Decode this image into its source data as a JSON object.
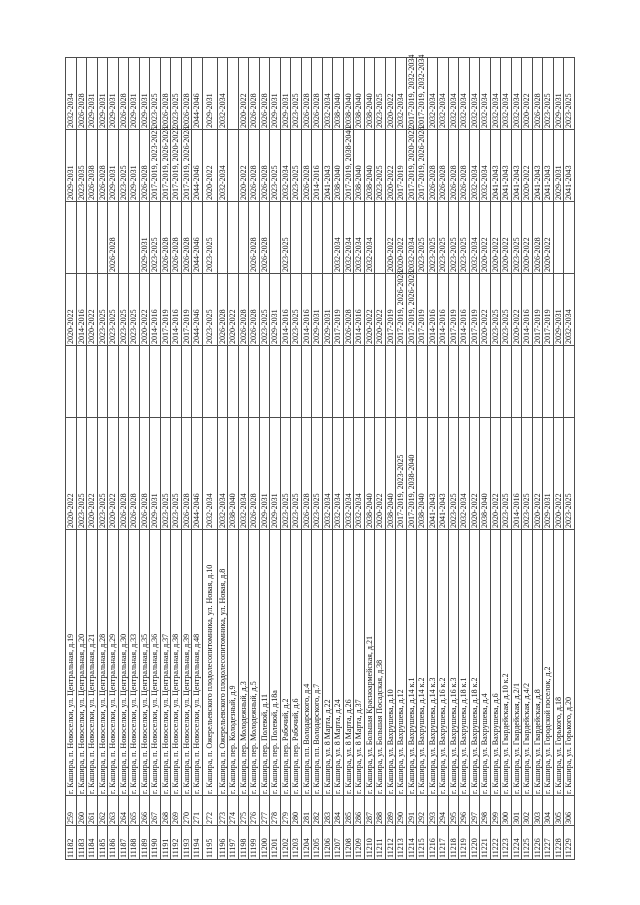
{
  "page": {
    "background": "#ffffff",
    "text_color": "#141414",
    "grid_color": "#4d4d4d"
  },
  "table": {
    "description_of_visible_content": "portion of a rotated schedule table: row number, ordinal number, building address, and planned year-range periods",
    "tall_row_index": 13,
    "rows": [
      [
        "11182",
        "259",
        "г. Кашира, п. Новоселки, ул. Центральная, д.19",
        "2020-2022",
        "",
        "2020-2022",
        "",
        "2029-2031",
        "2032-2034"
      ],
      [
        "11183",
        "260",
        "г. Кашира, п. Новоселки, ул. Центральная, д.20",
        "2023-2025",
        "",
        "2014-2016",
        "",
        "2023-2035",
        "2026-2028"
      ],
      [
        "11184",
        "261",
        "г. Кашира, п. Новоселки, ул. Центральная, д.21",
        "2020-2022",
        "",
        "2020-2022",
        "",
        "2026-2038",
        "2029-2031"
      ],
      [
        "11185",
        "262",
        "г. Кашира, п. Новоселки, ул. Центральная, д.28",
        "2023-2025",
        "",
        "2023-2025",
        "",
        "2026-2028",
        "2029-2031"
      ],
      [
        "11186",
        "263",
        "г. Кашира, п. Новоселки, ул. Центральная, д.29",
        "2020-2022",
        "",
        "2023-2025",
        "2026-2028",
        "2029-2031",
        "2029-2031"
      ],
      [
        "11187",
        "264",
        "г. Кашира, п. Новоселки, ул. Центральная, д.30",
        "2026-2028",
        "",
        "2023-2025",
        "",
        "2023-2025",
        "2026-2028"
      ],
      [
        "11188",
        "265",
        "г. Кашира, п. Новоселки, ул. Центральная, д.33",
        "2026-2028",
        "",
        "2023-2025",
        "",
        "2029-2031",
        "2029-2031"
      ],
      [
        "11189",
        "266",
        "г. Кашира, п. Новоселки, ул. Центральная, д.35",
        "2026-2028",
        "",
        "2020-2022",
        "2029-2031",
        "2026-2028",
        "2029-2031"
      ],
      [
        "11190",
        "267",
        "г. Кашира, п. Новоселки, ул. Центральная, д.36",
        "2029-2031",
        "",
        "2014-2016",
        "2023-2025",
        "2017-2019, 2023-2025",
        "2023-2025"
      ],
      [
        "11191",
        "268",
        "г. Кашира, п. Новоселки, ул. Центральная, д.37",
        "2023-2025",
        "",
        "2017-2019",
        "2026-2028",
        "2017-2019, 2026-2028",
        "2026-2028"
      ],
      [
        "11192",
        "269",
        "г. Кашира, п. Новоселки, ул. Центральная, д.38",
        "2023-2025",
        "",
        "2014-2016",
        "2026-2028",
        "2017-2019, 2020-2022",
        "2023-2025"
      ],
      [
        "11193",
        "270",
        "г. Кашира, п. Новоселки, ул. Центральная, д.39",
        "2026-2028",
        "",
        "2017-2019",
        "2026-2028",
        "2017-2019, 2026-2028",
        "2026-2028"
      ],
      [
        "11194",
        "271",
        "г. Кашира, п. Новоселки, ул. Центральная, д.48",
        "2044-2046",
        "",
        "2044-2046",
        "2044-2046",
        "2044-2046",
        "2044-2046"
      ],
      [
        "11195",
        "272",
        "г. Кашира, п. Ожерельевского плодолесопитомника, ул. Новая, д.10",
        "2032-2034",
        "",
        "2023-2025",
        "2023-2025",
        "2020-2022",
        "2029-2031"
      ],
      [
        "11196",
        "273",
        "г. Кашира, п. Ожерельевского плодолесопитомника, ул. Новая, д.8",
        "2032-2034",
        "",
        "2026-2028",
        "",
        "2032-2034",
        "2032-2034"
      ],
      [
        "11197",
        "274",
        "г. Кашира, пер. Колодезный, д.9",
        "2038-2040",
        "",
        "2020-2022",
        "",
        "",
        ""
      ],
      [
        "11198",
        "275",
        "г. Кашира, пер. Молодежный, д.3",
        "2032-2034",
        "",
        "2026-2028",
        "",
        "2020-2022",
        "2020-2022"
      ],
      [
        "11199",
        "276",
        "г. Кашира, пер. Молодежный, д.5",
        "2026-2028",
        "",
        "2026-2028",
        "2026-2028",
        "2026-2028",
        "2026-2028"
      ],
      [
        "11200",
        "277",
        "г. Кашира, пер. Полевой, д.11",
        "2029-2031",
        "",
        "2023-2025",
        "2026-2028",
        "2026-2028",
        "2026-2028"
      ],
      [
        "11201",
        "278",
        "г. Кашира, пер. Полевой, д.18а",
        "2029-2031",
        "",
        "2029-2031",
        "",
        "2023-2025",
        "2029-2031"
      ],
      [
        "11202",
        "279",
        "г. Кашира, пер. Рабочий, д.2",
        "2023-2025",
        "",
        "2014-2016",
        "2023-2025",
        "2032-2034",
        "2029-2031"
      ],
      [
        "11203",
        "280",
        "г. Кашира, пер. Рабочий, д.6",
        "2023-2025",
        "",
        "2023-2025",
        "",
        "2023-2025",
        "2023-2025"
      ],
      [
        "11204",
        "281",
        "г. Кашира, пл. Володарского, д.4",
        "2026-2028",
        "",
        "2014-2016",
        "",
        "2026-2028",
        "2026-2028"
      ],
      [
        "11205",
        "282",
        "г. Кашира, пл. Володарского, д.7",
        "2023-2025",
        "",
        "2029-2031",
        "",
        "2014-2016",
        "2026-2028"
      ],
      [
        "11206",
        "283",
        "г. Кашира, ул. 8 Марта, д.22",
        "2032-2034",
        "",
        "2029-2031",
        "",
        "2041-2043",
        "2032-2034"
      ],
      [
        "11207",
        "284",
        "г. Кашира, ул. 8 Марта, д.24",
        "2032-2034",
        "",
        "2017-2019",
        "2032-2034",
        "2038-2040",
        "2038-2040"
      ],
      [
        "11208",
        "285",
        "г. Кашира, ул. 8 Марта, д.26",
        "2032-2034",
        "",
        "2026-2028",
        "2032-2034",
        "2017-2019, 2038-2040",
        "2038-2040"
      ],
      [
        "11209",
        "286",
        "г. Кашира, ул. 8 Марта, д.37",
        "2032-2034",
        "",
        "2014-2016",
        "2032-2034",
        "2038-2040",
        "2038-2040"
      ],
      [
        "11210",
        "287",
        "г. Кашира, ул. Большая Красноармейская, д.21",
        "2038-2040",
        "",
        "2020-2022",
        "2032-2034",
        "2038-2040",
        "2038-2040"
      ],
      [
        "11211",
        "288",
        "г. Кашира, ул. Большая Посадская, д.38",
        "2020-2022",
        "",
        "2020-2022",
        "",
        "2023-2025",
        "2023-2025"
      ],
      [
        "11212",
        "289",
        "г. Кашира, ул. Вахрушева, д.10",
        "2038-2040",
        "",
        "2017-2019",
        "2020-2022",
        "2020-2022",
        "2020-2022"
      ],
      [
        "11213",
        "290",
        "г. Кашира, ул. Вахрушева, д.12",
        "2017-2019, 2023-2025",
        "",
        "2017-2019, 2026-2028",
        "2020-2022",
        "2017-2019",
        "2032-2034"
      ],
      [
        "11214",
        "291",
        "г. Кашира, ул. Вахрушева, д.14 к.1",
        "2017-2019, 2038-2040",
        "",
        "2017-2019, 2026-2028",
        "2032-2034",
        "2017-2019, 2020-2022",
        "2017-2019, 2032-2034"
      ],
      [
        "11215",
        "292",
        "г. Кашира, ул. Вахрушева, д.14 к.2",
        "2038-2040",
        "",
        "2017-2019",
        "2023-2025",
        "2017-2019, 2026-2028",
        "2017-2019, 2032-2034"
      ],
      [
        "11216",
        "293",
        "г. Кашира, ул. Вахрушева, д.14 к.3",
        "2041-2043",
        "",
        "2014-2016",
        "2023-2025",
        "2026-2028",
        "2032-2034"
      ],
      [
        "11217",
        "294",
        "г. Кашира, ул. Вахрушева, д.16 к.2",
        "2041-2043",
        "",
        "2014-2016",
        "2023-2025",
        "2026-2028",
        "2032-2034"
      ],
      [
        "11218",
        "295",
        "г. Кашира, ул. Вахрушева, д.16 к.3",
        "2023-2025",
        "",
        "2017-2019",
        "2023-2025",
        "2026-2028",
        "2032-2034"
      ],
      [
        "11219",
        "296",
        "г. Кашира, ул. Вахрушева, д.18 к.1",
        "2032-2034",
        "",
        "2014-2016",
        "2023-2025",
        "2026-2028",
        "2032-2034"
      ],
      [
        "11220",
        "297",
        "г. Кашира, ул. Вахрушева, д.18 к.2",
        "2020-2022",
        "",
        "2017-2019",
        "2032-2034",
        "2032-2034",
        "2032-2034"
      ],
      [
        "11221",
        "298",
        "г. Кашира, ул. Вахрушева, д.4",
        "2038-2040",
        "",
        "2020-2022",
        "2020-2022",
        "2032-2034",
        "2032-2034"
      ],
      [
        "11222",
        "299",
        "г. Кашира, ул. Вахрушева, д.6",
        "2020-2022",
        "",
        "2023-2025",
        "2020-2022",
        "2041-2043",
        "2032-2034"
      ],
      [
        "11223",
        "300",
        "г. Кашира, ул. Гвардейская, д.10 к.2",
        "2023-2025",
        "",
        "2023-2025",
        "2020-2022",
        "2041-2043",
        "2032-2034"
      ],
      [
        "11224",
        "301",
        "г. Кашира, ул. Гвардейская, д.2/1",
        "2014-2016",
        "",
        "2020-2022",
        "2023-2025",
        "2041-2043",
        "2032-2034"
      ],
      [
        "11225",
        "302",
        "г. Кашира, ул. Гвардейская, д.4/2",
        "2023-2025",
        "",
        "2014-2016",
        "2020-2022",
        "2020-2022",
        "2020-2022"
      ],
      [
        "11226",
        "303",
        "г. Кашира, ул. Гвардейская, д.8",
        "2020-2022",
        "",
        "2017-2019",
        "2026-2028",
        "2041-2043",
        "2026-2028"
      ],
      [
        "11227",
        "304",
        "г. Кашира, ул. Городской поселок, д.2",
        "2029-2031",
        "",
        "2017-2019",
        "2020-2022",
        "2041-2043",
        "2023-2025"
      ],
      [
        "11228",
        "305",
        "г. Кашира, ул. Горького, д.18",
        "2020-2022",
        "",
        "2029-2031",
        "",
        "2029-2031",
        "2029-2031"
      ],
      [
        "11229",
        "306",
        "г. Кашира, ул. Горького, д.20",
        "2023-2025",
        "",
        "2032-2034",
        "",
        "2041-2043",
        "2023-2025"
      ]
    ]
  }
}
